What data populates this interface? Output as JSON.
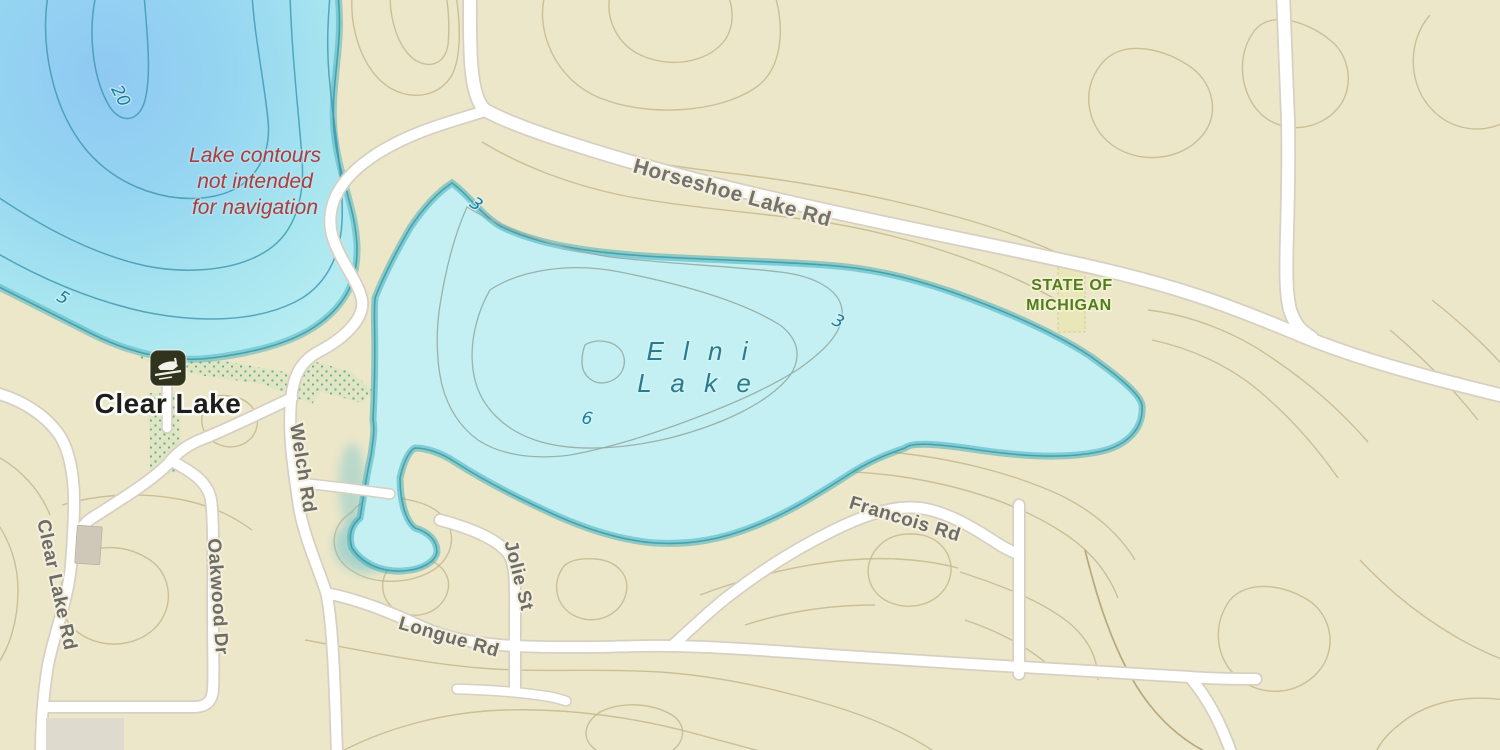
{
  "map": {
    "kind": "topographic-lake-map",
    "colors": {
      "land": "#ECE7C9",
      "land_contour": "#C6B78E",
      "elni_water": "#C4F0F3",
      "water_edge_band": "#49AEBC",
      "water_edge_line": "#2F98A8",
      "clear_lake_deep": "#8FC8F2",
      "road_fill": "#FFFFFF",
      "road_casing": "#D6D0C2",
      "road_label": "#6D6C66",
      "state_land_green": "#527D1D",
      "disclaimer_red": "#AD3C3E",
      "elni_label_teal": "#2A7B8E",
      "depth_label_teal": "#1A7D9B",
      "wetland_dot": "#79B0A0",
      "boat_icon_bg": "#31341D"
    }
  },
  "lakes": {
    "clear": {
      "name": "Clear Lake",
      "depths": [
        "20",
        "5"
      ]
    },
    "elni": {
      "name1": "E l n i",
      "name2": "L a k e",
      "depths": [
        "3",
        "3",
        "6"
      ]
    }
  },
  "roads": {
    "horseshoe": "Horseshoe Lake Rd",
    "welch": "Welch Rd",
    "oakwood": "Oakwood Dr",
    "clear_lake_rd": "Clear Lake Rd",
    "longue": "Longue Rd",
    "jolie": "Jolie St",
    "francois": "Francois Rd"
  },
  "notes": {
    "disclaimer": [
      "Lake contours",
      "not intended",
      "for navigation"
    ],
    "ownership": [
      "STATE OF",
      "MICHIGAN"
    ]
  },
  "icons": {
    "boat_launch": "boat-launch"
  }
}
